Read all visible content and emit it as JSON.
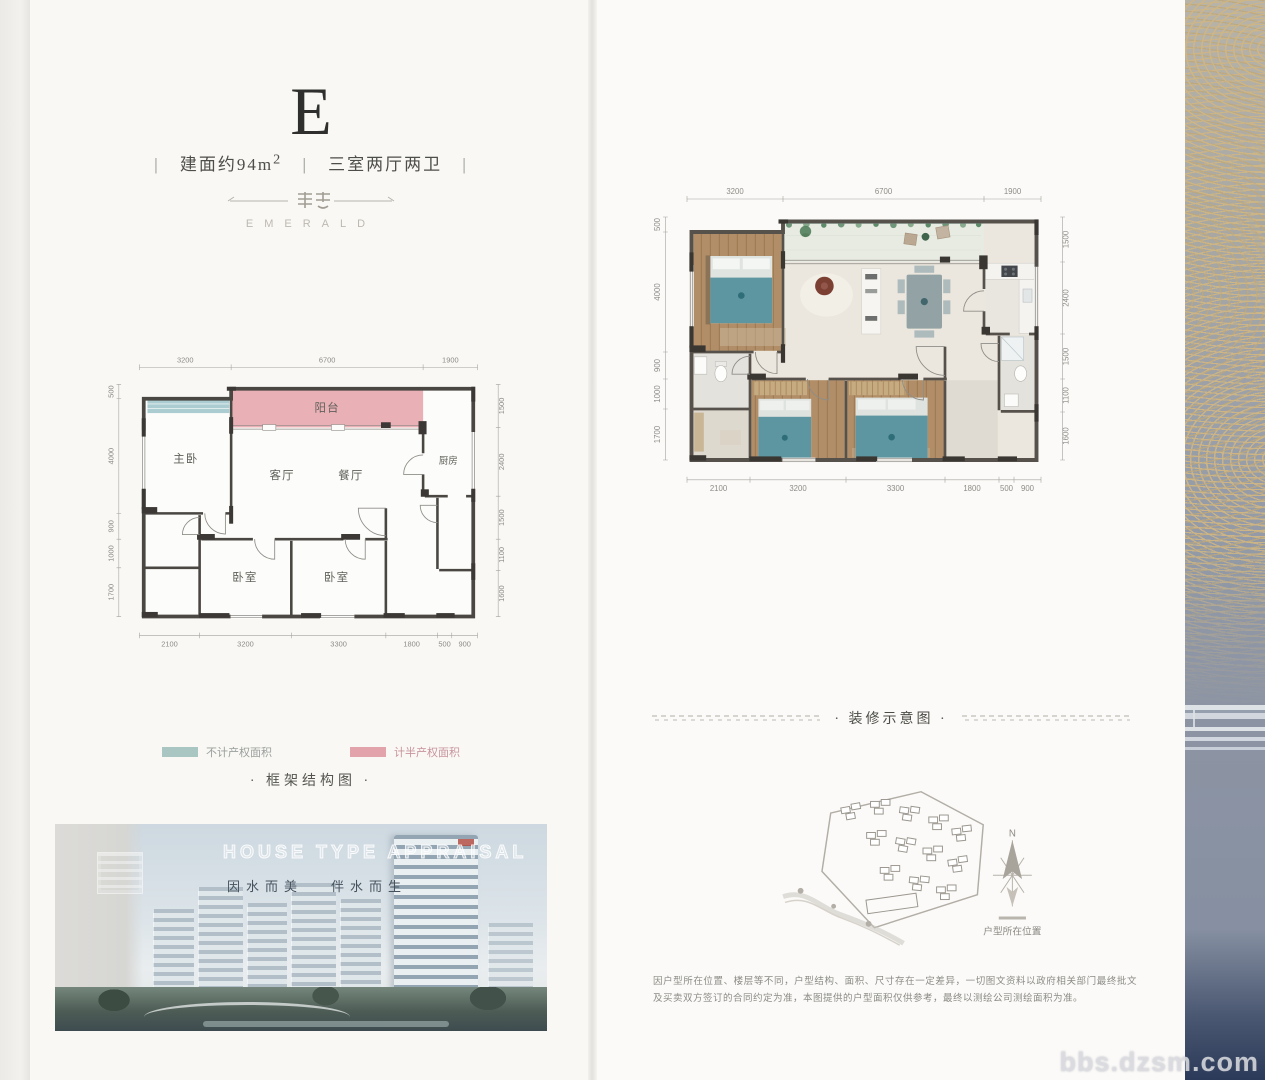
{
  "header": {
    "unit_letter": "E",
    "separator": "|",
    "area_label": "建面约94m",
    "area_sup": "2",
    "layout_label": "三室两厅两卫",
    "brand_name": "EMERALD"
  },
  "frame_plan": {
    "title": "· 框架结构图 ·",
    "legend": [
      {
        "label": "不计产权面积",
        "color": "#a9c6c3"
      },
      {
        "label": "计半产权面积",
        "color": "#e3a3ab"
      }
    ],
    "rooms": {
      "master": "主卧",
      "balcony": "阳台",
      "living": "客厅",
      "dining": "餐厅",
      "kitchen": "厨房",
      "bedroom_a": "卧室",
      "bedroom_b": "卧室"
    },
    "dims_top": [
      "3200",
      "6700",
      "1900"
    ],
    "dims_bottom": [
      "2100",
      "3200",
      "3300",
      "1800",
      "500",
      "900"
    ],
    "dims_left": [
      "500",
      "4000",
      "900",
      "1000",
      "1700"
    ],
    "dims_right": [
      "1500",
      "2400",
      "1500",
      "1100",
      "1600"
    ]
  },
  "photo": {
    "title": "HOUSE TYPE APPRAISAL",
    "slogan_a": "因水而美",
    "slogan_b": "伴水而生"
  },
  "decor_plan": {
    "title": "· 装修示意图 ·",
    "dims_top": [
      "3200",
      "6700",
      "1900"
    ],
    "dims_bottom": [
      "2100",
      "3200",
      "3300",
      "1800",
      "500",
      "900"
    ],
    "dims_left": [
      "500",
      "4000",
      "900",
      "1000",
      "1700"
    ],
    "dims_right": [
      "1500",
      "2400",
      "1500",
      "1100",
      "1600"
    ]
  },
  "site_map": {
    "north_label": "N",
    "location_label": "户型所在位置"
  },
  "disclaimer": "因户型所在位置、楼层等不同，户型结构、面积、尺寸存在一定差异，一切图文资料以政府相关部门最终批文及买卖双方签订的合同约定为准，本图提供的户型面积仅供参考，最终以测绘公司测绘面积为准。",
  "watermark": "bbs.dzsm.com",
  "colors": {
    "balcony_pink": "#e7a9b0",
    "window_teal": "#abccd1",
    "wood_floor": "#b18e67",
    "bed_teal": "#5d96a0"
  }
}
